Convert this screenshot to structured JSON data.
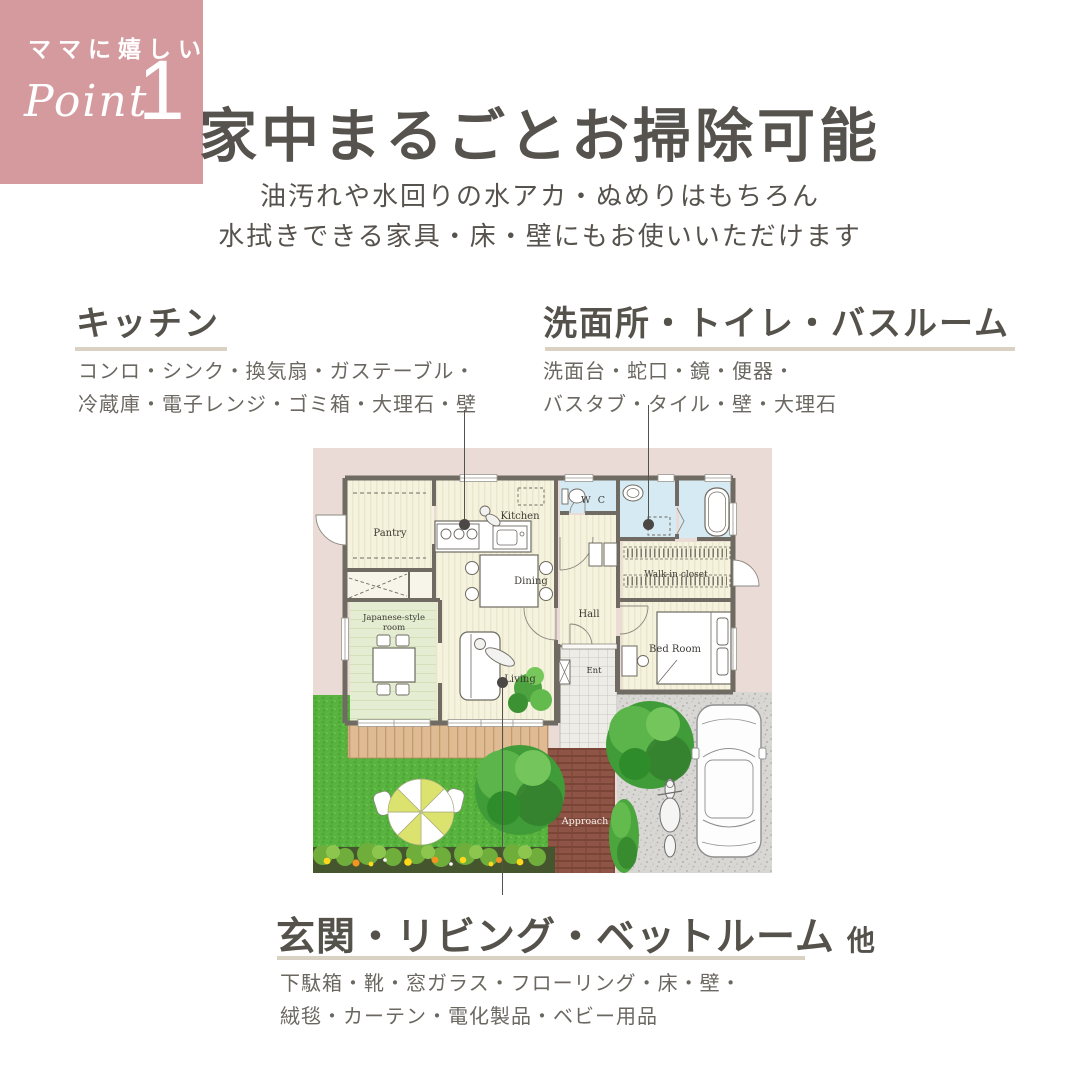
{
  "badge": {
    "tagline": "ママに嬉しい",
    "point_label": "Point",
    "point_number": "1"
  },
  "header": {
    "title": "家中まるごとお掃除可能",
    "subtitle_line1": "油汚れや水回りの水アカ・ぬめりはもちろん",
    "subtitle_line2": "水拭きできる家具・床・壁にもお使いいただけます"
  },
  "sections": {
    "kitchen": {
      "heading": "キッチン",
      "items_line1": "コンロ・シンク・換気扇・ガステーブル・",
      "items_line2": "冷蔵庫・電子レンジ・ゴミ箱・大理石・壁"
    },
    "sanitary": {
      "heading": "洗面所・トイレ・バスルーム",
      "items_line1": "洗面台・蛇口・鏡・便器・",
      "items_line2": "バスタブ・タイル・壁・大理石"
    },
    "living": {
      "heading": "玄関・リビング・ベットルーム",
      "heading_suffix": "他",
      "items_line1": "下駄箱・靴・窓ガラス・フローリング・床・壁・",
      "items_line2": "絨毯・カーテン・電化製品・ベビー用品"
    }
  },
  "floorplan": {
    "rooms": {
      "pantry": "Pantry",
      "kitchen": "Kitchen",
      "wc": "W C",
      "dining": "Dining",
      "hall": "Hall",
      "walkin_closet": "Walk-in closet",
      "japanese_line1": "Japanese-style",
      "japanese_line2": "room",
      "living": "Living",
      "entrance": "Ent",
      "bedroom": "Bed Room",
      "approach": "Approach"
    }
  },
  "colors": {
    "badge_pink": "#d49a9e",
    "underline_beige": "#d9d2c2",
    "text_dark": "#56524d",
    "text_body": "#6b6761",
    "plan_background_pink": "#ebdbd7",
    "lawn_green": "#57b23e",
    "wet_room_blue": "#d6eaf3",
    "room_cream": "#f5f2dd"
  }
}
